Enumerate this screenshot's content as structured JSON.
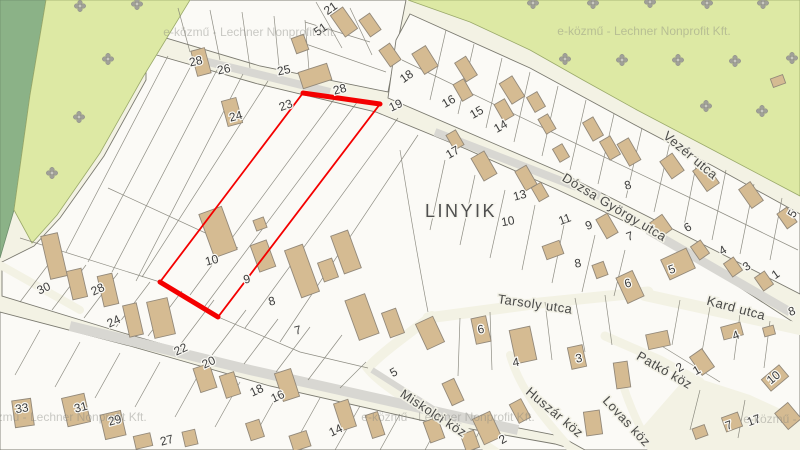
{
  "map": {
    "attribution_watermark": "e-közmű - Lechner Nonprofit Kft.",
    "colors": {
      "highlight_red": "#f40000",
      "building_tan": "#d5bb92",
      "forest_dark_green": "#8bb287",
      "vegetation_light_green": "#dde9a4",
      "road_cream": "#f3f2e4",
      "road_gray": "#d8d7d2",
      "parcel_white": "#fbfaf6",
      "label_gray": "#4a4a48"
    },
    "area_labels": [
      {
        "text": "LINYIK",
        "x": 461,
        "y": 212,
        "rot": 0
      }
    ],
    "street_labels": [
      {
        "text": "Dózsa György utca",
        "x": 614,
        "y": 208,
        "rot": 31
      },
      {
        "text": "Vezér utca",
        "x": 690,
        "y": 156,
        "rot": 40
      },
      {
        "text": "Tarsoly utca",
        "x": 535,
        "y": 305,
        "rot": 8
      },
      {
        "text": "Kard utca",
        "x": 736,
        "y": 309,
        "rot": 15
      },
      {
        "text": "Miskolci köz",
        "x": 433,
        "y": 414,
        "rot": 33
      },
      {
        "text": "Huszár köz",
        "x": 554,
        "y": 413,
        "rot": 40
      },
      {
        "text": "Lovas köz",
        "x": 626,
        "y": 422,
        "rot": 47
      },
      {
        "text": "Patkó köz",
        "x": 664,
        "y": 371,
        "rot": 30
      }
    ],
    "parcel_numbers": [
      {
        "text": "21",
        "x": 331,
        "y": 9,
        "rot": -35
      },
      {
        "text": "51",
        "x": 321,
        "y": 30,
        "rot": -35
      },
      {
        "text": "28",
        "x": 196,
        "y": 62,
        "rot": -12
      },
      {
        "text": "26",
        "x": 224,
        "y": 70,
        "rot": -12
      },
      {
        "text": "25",
        "x": 284,
        "y": 71,
        "rot": -12
      },
      {
        "text": "23",
        "x": 286,
        "y": 106,
        "rot": -20
      },
      {
        "text": "24",
        "x": 236,
        "y": 117,
        "rot": -15
      },
      {
        "text": "28",
        "x": 340,
        "y": 90,
        "rot": -15
      },
      {
        "text": "19",
        "x": 396,
        "y": 106,
        "rot": -25,
        "size": 15
      },
      {
        "text": "18",
        "x": 407,
        "y": 77,
        "rot": -35
      },
      {
        "text": "16",
        "x": 449,
        "y": 102,
        "rot": -30
      },
      {
        "text": "15",
        "x": 477,
        "y": 113,
        "rot": -30
      },
      {
        "text": "14",
        "x": 501,
        "y": 127,
        "rot": -30
      },
      {
        "text": "17",
        "x": 453,
        "y": 153,
        "rot": -30
      },
      {
        "text": "13",
        "x": 520,
        "y": 196,
        "rot": -15
      },
      {
        "text": "10",
        "x": 508,
        "y": 222,
        "rot": -10
      },
      {
        "text": "11",
        "x": 565,
        "y": 220,
        "rot": -20
      },
      {
        "text": "9",
        "x": 589,
        "y": 226,
        "rot": -20
      },
      {
        "text": "8",
        "x": 628,
        "y": 186,
        "rot": -15
      },
      {
        "text": "7",
        "x": 630,
        "y": 237,
        "rot": -20
      },
      {
        "text": "6",
        "x": 688,
        "y": 228,
        "rot": -30
      },
      {
        "text": "4",
        "x": 723,
        "y": 251,
        "rot": -30
      },
      {
        "text": "3",
        "x": 747,
        "y": 267,
        "rot": -35
      },
      {
        "text": "1",
        "x": 776,
        "y": 275,
        "rot": -35
      },
      {
        "text": "5",
        "x": 672,
        "y": 270,
        "rot": -20
      },
      {
        "text": "5",
        "x": 793,
        "y": 214,
        "rot": -60
      },
      {
        "text": "8",
        "x": 578,
        "y": 264,
        "rot": -10
      },
      {
        "text": "6",
        "x": 628,
        "y": 284,
        "rot": -15
      },
      {
        "text": "8",
        "x": 792,
        "y": 312,
        "rot": -20
      },
      {
        "text": "10",
        "x": 212,
        "y": 261,
        "rot": -15
      },
      {
        "text": "9",
        "x": 247,
        "y": 280,
        "rot": -15
      },
      {
        "text": "8",
        "x": 272,
        "y": 302,
        "rot": -15
      },
      {
        "text": "7",
        "x": 298,
        "y": 331,
        "rot": -15
      },
      {
        "text": "30",
        "x": 44,
        "y": 289,
        "rot": -25
      },
      {
        "text": "28",
        "x": 98,
        "y": 290,
        "rot": -25
      },
      {
        "text": "24",
        "x": 114,
        "y": 322,
        "rot": -25
      },
      {
        "text": "22",
        "x": 181,
        "y": 350,
        "rot": -25
      },
      {
        "text": "20",
        "x": 209,
        "y": 363,
        "rot": -25
      },
      {
        "text": "18",
        "x": 257,
        "y": 391,
        "rot": -25
      },
      {
        "text": "16",
        "x": 278,
        "y": 397,
        "rot": -25
      },
      {
        "text": "14",
        "x": 336,
        "y": 431,
        "rot": -25
      },
      {
        "text": "33",
        "x": 22,
        "y": 409,
        "rot": -8
      },
      {
        "text": "31",
        "x": 81,
        "y": 408,
        "rot": -15
      },
      {
        "text": "29",
        "x": 115,
        "y": 421,
        "rot": -15
      },
      {
        "text": "27",
        "x": 167,
        "y": 441,
        "rot": -15
      },
      {
        "text": "5",
        "x": 394,
        "y": 373,
        "rot": -30
      },
      {
        "text": "6",
        "x": 481,
        "y": 330,
        "rot": -10
      },
      {
        "text": "4",
        "x": 516,
        "y": 363,
        "rot": -10
      },
      {
        "text": "3",
        "x": 579,
        "y": 359,
        "rot": -10
      },
      {
        "text": "2",
        "x": 503,
        "y": 440,
        "rot": -30
      },
      {
        "text": "2",
        "x": 680,
        "y": 368,
        "rot": -30
      },
      {
        "text": "1",
        "x": 697,
        "y": 371,
        "rot": -30
      },
      {
        "text": "4",
        "x": 736,
        "y": 336,
        "rot": -20
      },
      {
        "text": "10",
        "x": 774,
        "y": 378,
        "rot": -40
      },
      {
        "text": "7",
        "x": 729,
        "y": 426,
        "rot": -20
      },
      {
        "text": "17",
        "x": 754,
        "y": 421,
        "rot": -20
      }
    ],
    "watermarks": [
      {
        "x": 250,
        "y": 33
      },
      {
        "x": 644,
        "y": 32
      },
      {
        "x": 60,
        "y": 418
      },
      {
        "x": 448,
        "y": 418
      },
      {
        "x": 830,
        "y": 420
      }
    ],
    "red_highlight": {
      "outline_points": "303,93 380,104 218,317 160,282",
      "thick_top_points": "303,93 380,104",
      "thick_bottom_points": "160,282 218,317"
    }
  }
}
